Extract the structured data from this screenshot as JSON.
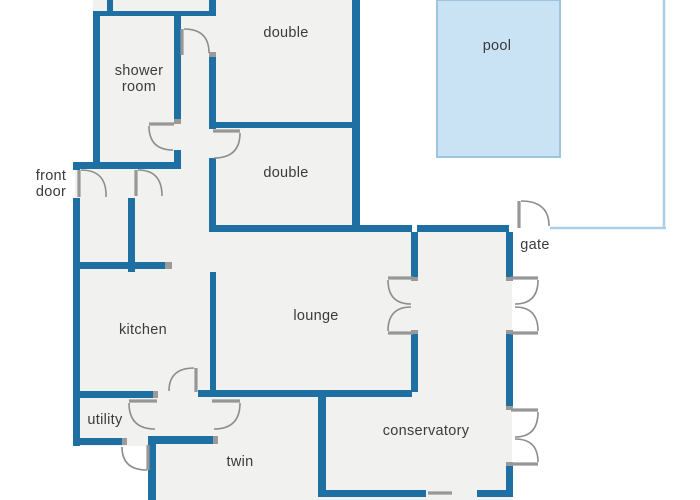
{
  "title": "villa floor plan with pool",
  "canvas": {
    "w": 700,
    "h": 500
  },
  "colors": {
    "wall": "#1f70a2",
    "floor": "#f1f2f0",
    "outside": "#ffffff",
    "pool_fill": "#c9e2f4",
    "pool_stroke": "#9dc5df",
    "fence": "#aacfe8",
    "door": "#8d8d8d",
    "leaf": "#979797",
    "jamb": "#9a9a9a",
    "label": "#3b3b3b"
  },
  "floors": [
    {
      "name": "floor-top-block",
      "x": 93,
      "y": 0,
      "w": 267,
      "h": 232
    },
    {
      "name": "floor-west-block",
      "x": 75,
      "y": 162,
      "w": 143,
      "h": 284
    },
    {
      "name": "floor-south-block",
      "x": 148,
      "y": 232,
      "w": 364,
      "h": 268
    }
  ],
  "pool": {
    "label": "pool",
    "x": 437,
    "y": 0,
    "w": 123,
    "h": 157,
    "label_x": 497,
    "label_y": 50
  },
  "fence": [
    {
      "name": "fence-east",
      "x1": 664,
      "y1": 0,
      "x2": 664,
      "y2": 228
    },
    {
      "name": "fence-south",
      "x1": 550,
      "y1": 228,
      "x2": 666,
      "y2": 228
    }
  ],
  "walls": [
    {
      "name": "wall-top-north",
      "x": 93,
      "y": 11,
      "w": 123,
      "h": 5
    },
    {
      "name": "wall-top-stub",
      "x": 107,
      "y": 0,
      "w": 6,
      "h": 11
    },
    {
      "name": "wall-shower-west",
      "x": 93,
      "y": 11,
      "w": 7,
      "h": 151
    },
    {
      "name": "wall-shower-east-upper",
      "x": 174,
      "y": 16,
      "w": 7,
      "h": 103
    },
    {
      "name": "wall-shower-east-lower",
      "x": 174,
      "y": 150,
      "w": 7,
      "h": 13
    },
    {
      "name": "wall-entry-north",
      "x": 73,
      "y": 162,
      "w": 108,
      "h": 7
    },
    {
      "name": "wall-west-upper",
      "x": 73,
      "y": 162,
      "w": 7,
      "h": 8
    },
    {
      "name": "wall-west-main",
      "x": 73,
      "y": 198,
      "w": 7,
      "h": 248
    },
    {
      "name": "wall-corridor-east-stub",
      "x": 209,
      "y": 0,
      "w": 7,
      "h": 11
    },
    {
      "name": "wall-corridor-east-mid",
      "x": 209,
      "y": 57,
      "w": 7,
      "h": 72
    },
    {
      "name": "wall-corridor-east-lower",
      "x": 209,
      "y": 158,
      "w": 7,
      "h": 74
    },
    {
      "name": "wall-doubles-divider",
      "x": 212,
      "y": 122,
      "w": 148,
      "h": 6
    },
    {
      "name": "wall-doubles-east",
      "x": 352,
      "y": 0,
      "w": 8,
      "h": 232
    },
    {
      "name": "wall-lounge-north",
      "x": 212,
      "y": 225,
      "w": 200,
      "h": 7
    },
    {
      "name": "wall-yard-south",
      "x": 417,
      "y": 225,
      "w": 92,
      "h": 7
    },
    {
      "name": "wall-vestibule",
      "x": 128,
      "y": 198,
      "w": 7,
      "h": 74
    },
    {
      "name": "wall-kitchen-north",
      "x": 75,
      "y": 262,
      "w": 90,
      "h": 7
    },
    {
      "name": "wall-kitchen-east",
      "x": 210,
      "y": 272,
      "w": 6,
      "h": 120
    },
    {
      "name": "wall-lounge-east-upper",
      "x": 411,
      "y": 232,
      "w": 7,
      "h": 45
    },
    {
      "name": "wall-lounge-east-lower",
      "x": 411,
      "y": 334,
      "w": 7,
      "h": 58
    },
    {
      "name": "wall-south-kitchen",
      "x": 75,
      "y": 391,
      "w": 78,
      "h": 7
    },
    {
      "name": "wall-south-main",
      "x": 198,
      "y": 390,
      "w": 214,
      "h": 7
    },
    {
      "name": "wall-utility-south",
      "x": 75,
      "y": 438,
      "w": 47,
      "h": 7
    },
    {
      "name": "wall-hall-south",
      "x": 148,
      "y": 436,
      "w": 65,
      "h": 8
    },
    {
      "name": "wall-twin-west",
      "x": 148,
      "y": 438,
      "w": 8,
      "h": 62
    },
    {
      "name": "wall-twin-divider",
      "x": 318,
      "y": 390,
      "w": 8,
      "h": 103
    },
    {
      "name": "wall-bottom-west",
      "x": 318,
      "y": 490,
      "w": 108,
      "h": 7
    },
    {
      "name": "wall-bottom-east",
      "x": 477,
      "y": 490,
      "w": 36,
      "h": 7
    },
    {
      "name": "wall-east-upper",
      "x": 506,
      "y": 232,
      "w": 7,
      "h": 45
    },
    {
      "name": "wall-east-mid",
      "x": 506,
      "y": 334,
      "w": 7,
      "h": 76
    },
    {
      "name": "wall-east-lower",
      "x": 506,
      "y": 466,
      "w": 7,
      "h": 31
    }
  ],
  "jambs": [
    {
      "name": "jamb-shower-door",
      "x": 174,
      "y": 119,
      "w": 7,
      "h": 5
    },
    {
      "name": "jamb-corridor-door",
      "x": 209,
      "y": 52,
      "w": 7,
      "h": 5
    },
    {
      "name": "jamb-kitchen-north",
      "x": 165,
      "y": 262,
      "w": 7,
      "h": 7
    },
    {
      "name": "jamb-south-kitchen",
      "x": 153,
      "y": 391,
      "w": 5,
      "h": 7
    },
    {
      "name": "jamb-utility-south",
      "x": 122,
      "y": 438,
      "w": 5,
      "h": 7
    },
    {
      "name": "jamb-hall-south",
      "x": 213,
      "y": 436,
      "w": 5,
      "h": 8
    },
    {
      "name": "jamb-lounge-french-top",
      "x": 411,
      "y": 277,
      "w": 7,
      "h": 4
    },
    {
      "name": "jamb-lounge-french-bottom",
      "x": 411,
      "y": 330,
      "w": 7,
      "h": 4
    },
    {
      "name": "jamb-garden-french-top",
      "x": 506,
      "y": 277,
      "w": 7,
      "h": 4
    },
    {
      "name": "jamb-garden-french-bottom",
      "x": 506,
      "y": 330,
      "w": 7,
      "h": 4
    },
    {
      "name": "jamb-cons-french-top",
      "x": 506,
      "y": 406,
      "w": 7,
      "h": 4
    },
    {
      "name": "jamb-cons-french-bottom",
      "x": 506,
      "y": 462,
      "w": 7,
      "h": 4
    }
  ],
  "doors": [
    {
      "name": "front-door-swing",
      "leaf": [
        79,
        170,
        79,
        197
      ],
      "arc": [
        81,
        170,
        107,
        170,
        106,
        197
      ]
    },
    {
      "name": "entry-hall-door-swing",
      "leaf": [
        136,
        170,
        136,
        196
      ],
      "arc": [
        138,
        170,
        162,
        170,
        162,
        196
      ]
    },
    {
      "name": "shower-room-door-swing",
      "leaf": [
        149,
        124,
        174,
        124
      ],
      "arc": [
        149,
        126,
        149,
        150,
        173,
        150
      ]
    },
    {
      "name": "double-top-door-swing",
      "leaf": [
        182,
        29,
        182,
        55
      ],
      "arc": [
        184,
        29,
        209,
        29,
        209,
        53
      ]
    },
    {
      "name": "double-bottom-door-swing",
      "leaf": [
        213,
        131,
        240,
        131
      ],
      "arc": [
        240,
        133,
        240,
        158,
        214,
        158
      ]
    },
    {
      "name": "kitchen-door-swing",
      "leaf": [
        196,
        368,
        196,
        392
      ],
      "arc": [
        194,
        368,
        169,
        368,
        169,
        391
      ]
    },
    {
      "name": "hall-utility-door-swing",
      "leaf": [
        129,
        401,
        157,
        401
      ],
      "arc": [
        129,
        403,
        129,
        429,
        155,
        429
      ]
    },
    {
      "name": "hall-twin-door-swing",
      "leaf": [
        212,
        401,
        240,
        401
      ],
      "arc": [
        240,
        403,
        240,
        429,
        214,
        429
      ]
    },
    {
      "name": "utility-back-door-swing",
      "leaf": [
        148,
        445,
        148,
        470
      ],
      "arc": [
        147,
        470,
        122,
        470,
        122,
        447
      ]
    },
    {
      "name": "lounge-french-door-top",
      "leaf": [
        388,
        278,
        413,
        278
      ],
      "arc": [
        388,
        280,
        388,
        304,
        411,
        304
      ]
    },
    {
      "name": "lounge-french-door-bottom",
      "leaf": [
        388,
        333,
        413,
        333
      ],
      "arc": [
        388,
        331,
        388,
        307,
        411,
        307
      ]
    },
    {
      "name": "garden-french-door-top",
      "leaf": [
        511,
        278,
        538,
        278
      ],
      "arc": [
        538,
        280,
        538,
        304,
        515,
        304
      ]
    },
    {
      "name": "garden-french-door-bottom",
      "leaf": [
        511,
        333,
        538,
        333
      ],
      "arc": [
        538,
        331,
        538,
        307,
        515,
        307
      ]
    },
    {
      "name": "conservatory-french-door-top",
      "leaf": [
        511,
        410,
        538,
        410
      ],
      "arc": [
        538,
        412,
        538,
        437,
        515,
        437
      ]
    },
    {
      "name": "conservatory-french-door-bottom",
      "leaf": [
        511,
        464,
        538,
        464
      ],
      "arc": [
        538,
        462,
        538,
        439,
        515,
        439
      ]
    },
    {
      "name": "gate-door-swing",
      "leaf": [
        519,
        201,
        519,
        228
      ],
      "arc": [
        521,
        201,
        549,
        201,
        549,
        226
      ]
    },
    {
      "name": "conservatory-south-door",
      "leaf": [
        428,
        493,
        452,
        493
      ],
      "arc": null
    }
  ],
  "labels": [
    {
      "name": "label-shower-room",
      "lines": [
        "shower",
        "room"
      ],
      "x": 139,
      "y": 75,
      "lh": 16
    },
    {
      "name": "label-double-top",
      "lines": [
        "double"
      ],
      "x": 286,
      "y": 37,
      "lh": 16
    },
    {
      "name": "label-double-bottom",
      "lines": [
        "double"
      ],
      "x": 286,
      "y": 177,
      "lh": 16
    },
    {
      "name": "label-pool",
      "lines": [
        "pool"
      ],
      "x": 497,
      "y": 50,
      "lh": 16
    },
    {
      "name": "label-front-door",
      "lines": [
        "front",
        "door"
      ],
      "x": 51,
      "y": 180,
      "lh": 16
    },
    {
      "name": "label-gate",
      "lines": [
        "gate"
      ],
      "x": 535,
      "y": 249,
      "lh": 16
    },
    {
      "name": "label-kitchen",
      "lines": [
        "kitchen"
      ],
      "x": 143,
      "y": 334,
      "lh": 16
    },
    {
      "name": "label-lounge",
      "lines": [
        "lounge"
      ],
      "x": 316,
      "y": 320,
      "lh": 16
    },
    {
      "name": "label-utility",
      "lines": [
        "utility"
      ],
      "x": 105,
      "y": 424,
      "lh": 16
    },
    {
      "name": "label-twin",
      "lines": [
        "twin"
      ],
      "x": 240,
      "y": 466,
      "lh": 16
    },
    {
      "name": "label-conservatory",
      "lines": [
        "conservatory"
      ],
      "x": 426,
      "y": 435,
      "lh": 16
    }
  ]
}
